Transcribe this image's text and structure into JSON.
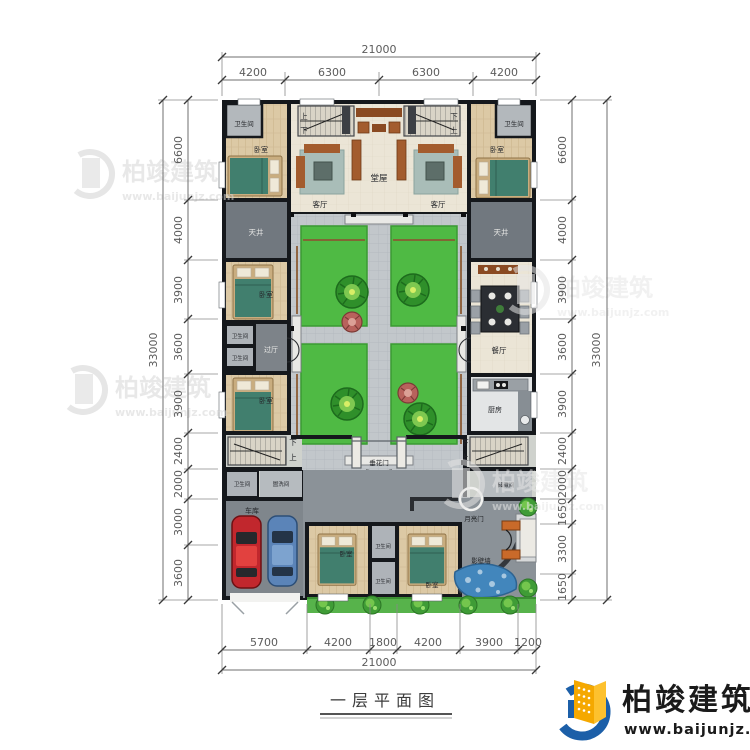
{
  "title": {
    "text": "一层平面图"
  },
  "brand": {
    "name": "柏竣建筑",
    "url": "www.baijunjz.com"
  },
  "watermark": {
    "name": "柏竣建筑",
    "url": "www.baijunjz.com"
  },
  "dims": {
    "top": {
      "total": "21000",
      "segs": [
        "4200",
        "6300",
        "6300",
        "4200"
      ]
    },
    "bottom": {
      "total": "21000",
      "segs": [
        "5700",
        "4200",
        "1800",
        "4200",
        "3900",
        "1200"
      ]
    },
    "left": {
      "total": "33000",
      "segs": [
        "6600",
        "4000",
        "3900",
        "3600",
        "3900",
        "2400",
        "2000",
        "3000",
        "3600"
      ]
    },
    "right": {
      "total": "33000",
      "segs": [
        "6600",
        "4000",
        "3900",
        "3600",
        "3900",
        "2400",
        "2000",
        "1650",
        "3300",
        "1650"
      ]
    }
  },
  "rooms": {
    "bath": "卫生间",
    "bedroom": "卧室",
    "living": "客厅",
    "hall": "堂屋",
    "lightwell": "天井",
    "dining": "餐厅",
    "kitchen": "厨房",
    "foyer": "过厅",
    "laundry": "盥洗间",
    "garage": "车库",
    "storage": "储藏间",
    "festoon_gate": "垂花门",
    "moon_gate": "月亮门",
    "screen_wall": "影壁墙",
    "stair_up": "上",
    "stair_down": "下"
  },
  "colors": {
    "brand_blue": "#1c5fa8",
    "brand_orange": "#f5a800",
    "lawn_green": "#4fba44",
    "water_blue": "#4286bc",
    "wall_black": "#15181c"
  }
}
